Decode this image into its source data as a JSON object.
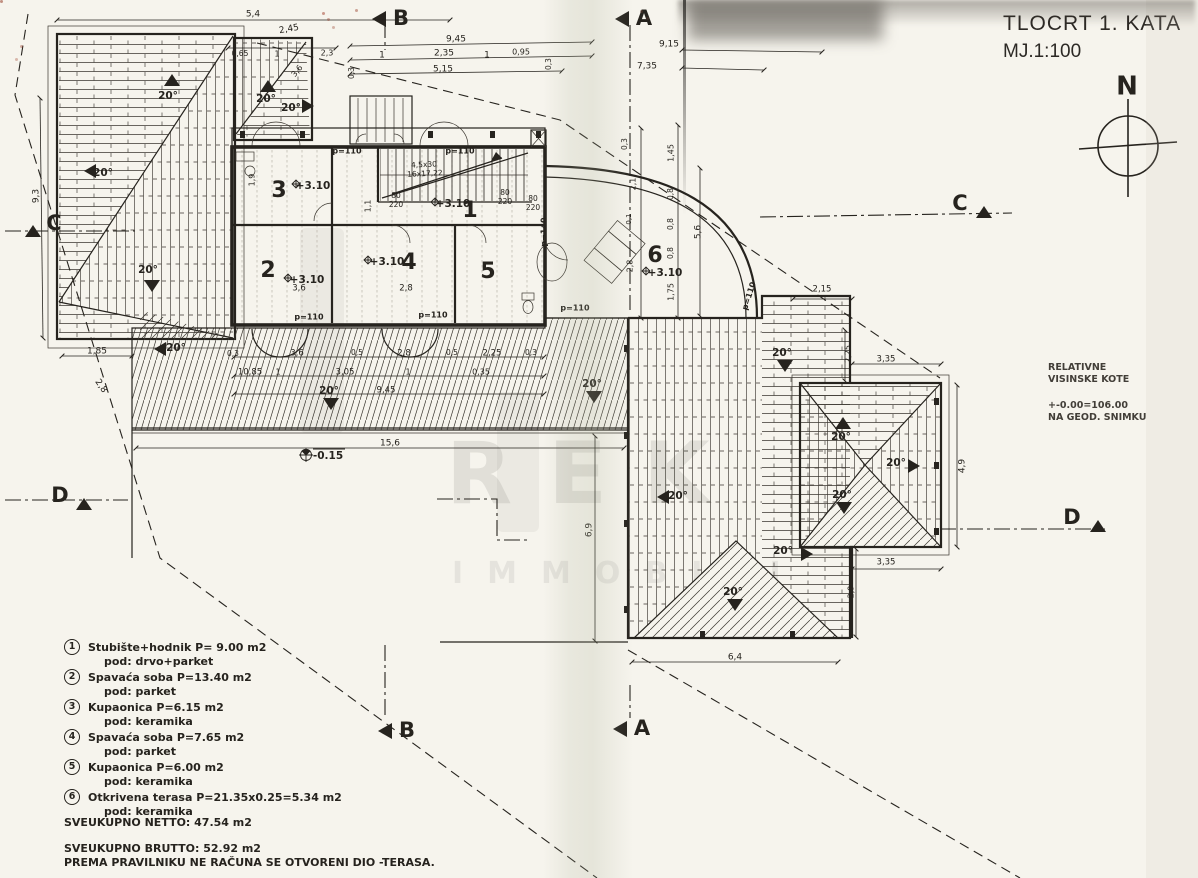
{
  "colors": {
    "ink": "#26231e",
    "paper": "#f6f4ed"
  },
  "title_block": {
    "title": "TLOCRT 1. KATA",
    "scale": "MJ.1:100"
  },
  "survey_note": {
    "line1": "RELATIVNE",
    "line2": "VISINSKE KOTE",
    "line3": "+-0.00=106.00",
    "line4": "NA GEOD. SNIMKU"
  },
  "watermark": {
    "big": "REK",
    "small": "IMMOBILI"
  },
  "legend": {
    "items": [
      {
        "num": "1",
        "desc": "Stubište+hodnik P= 9.00 m2",
        "floor": "pod: drvo+parket"
      },
      {
        "num": "2",
        "desc": "Spavaća soba P=13.40 m2",
        "floor": "pod: parket"
      },
      {
        "num": "3",
        "desc": "Kupaonica P=6.15 m2",
        "floor": "pod: keramika"
      },
      {
        "num": "4",
        "desc": "Spavaća soba P=7.65 m2",
        "floor": "pod: parket"
      },
      {
        "num": "5",
        "desc": "Kupaonica P=6.00 m2",
        "floor": "pod: keramika"
      },
      {
        "num": "6",
        "desc": "Otkrivena terasa P=21.35x0.25=5.34 m2",
        "floor": "pod: keramika"
      }
    ],
    "netto": "SVEUKUPNO NETTO: 47.54 m2",
    "brutto": "SVEUKUPNO BRUTTO: 52.92 m2",
    "note": "PREMA PRAVILNIKU NE RAČUNA SE OTVORENI DIO -TERASA."
  },
  "plan": {
    "annotations": [
      {
        "t": "B",
        "x": 401,
        "y": 19,
        "s": 21,
        "b": 1
      },
      {
        "t": "A",
        "x": 644,
        "y": 19,
        "s": 21,
        "b": 1
      },
      {
        "t": "C",
        "x": 54,
        "y": 224,
        "s": 21,
        "b": 1
      },
      {
        "t": "C",
        "x": 960,
        "y": 204,
        "s": 21,
        "b": 1
      },
      {
        "t": "D",
        "x": 60,
        "y": 496,
        "s": 21,
        "b": 1
      },
      {
        "t": "D",
        "x": 1072,
        "y": 518,
        "s": 21,
        "b": 1
      },
      {
        "t": "B",
        "x": 407,
        "y": 731,
        "s": 21,
        "b": 1
      },
      {
        "t": "A",
        "x": 642,
        "y": 729,
        "s": 21,
        "b": 1
      },
      {
        "t": "N",
        "x": 1127,
        "y": 87,
        "s": 26,
        "b": 1
      },
      {
        "t": "3",
        "x": 279,
        "y": 191,
        "s": 22,
        "b": 1
      },
      {
        "t": "2",
        "x": 268,
        "y": 271,
        "s": 22,
        "b": 1
      },
      {
        "t": "4",
        "x": 409,
        "y": 263,
        "s": 22,
        "b": 1
      },
      {
        "t": "1",
        "x": 470,
        "y": 211,
        "s": 22,
        "b": 1
      },
      {
        "t": "5",
        "x": 488,
        "y": 272,
        "s": 22,
        "b": 1
      },
      {
        "t": "6",
        "x": 655,
        "y": 256,
        "s": 22,
        "b": 1
      },
      {
        "t": "+3.10",
        "x": 313,
        "y": 186,
        "s": 10.5,
        "b": 1
      },
      {
        "t": "+3.10",
        "x": 307,
        "y": 280,
        "s": 10.5,
        "b": 1
      },
      {
        "t": "+3.10",
        "x": 387,
        "y": 262,
        "s": 10.5,
        "b": 1
      },
      {
        "t": "+3.10",
        "x": 453,
        "y": 204,
        "s": 10.5,
        "b": 1
      },
      {
        "t": "+3.10",
        "x": 665,
        "y": 273,
        "s": 10.5,
        "b": 1
      },
      {
        "t": "-0.15",
        "x": 328,
        "y": 456,
        "s": 10.5,
        "b": 1
      },
      {
        "t": "p=110",
        "x": 347,
        "y": 151,
        "s": 8,
        "b": 1
      },
      {
        "t": "p=110",
        "x": 460,
        "y": 151,
        "s": 8,
        "b": 1
      },
      {
        "t": "p=110",
        "x": 309,
        "y": 317,
        "s": 8,
        "b": 1
      },
      {
        "t": "p=110",
        "x": 433,
        "y": 315,
        "s": 8,
        "b": 1
      },
      {
        "t": "p=110",
        "x": 575,
        "y": 308,
        "s": 8,
        "b": 1
      },
      {
        "t": "p=110",
        "x": 749,
        "y": 296,
        "r": -72,
        "s": 8,
        "b": 1
      },
      {
        "t": "p=140",
        "x": 544,
        "y": 232,
        "r": -90,
        "s": 8,
        "b": 1
      },
      {
        "t": "80",
        "x": 396,
        "y": 196,
        "s": 7.5
      },
      {
        "t": "220",
        "x": 396,
        "y": 205,
        "s": 7.5
      },
      {
        "t": "80",
        "x": 505,
        "y": 193,
        "s": 7.5
      },
      {
        "t": "220",
        "x": 505,
        "y": 202,
        "s": 7.5
      },
      {
        "t": "80",
        "x": 533,
        "y": 199,
        "s": 7.5
      },
      {
        "t": "220",
        "x": 533,
        "y": 208,
        "s": 7.5
      },
      {
        "t": "4,5x30",
        "x": 424,
        "y": 165,
        "r": -3,
        "s": 7.5
      },
      {
        "t": "16x17,22",
        "x": 425,
        "y": 174,
        "r": -3,
        "s": 7.5
      },
      {
        "t": "20°",
        "x": 168,
        "y": 96,
        "s": 10.5,
        "b": 1
      },
      {
        "t": "20°",
        "x": 266,
        "y": 99,
        "s": 10.5,
        "b": 1
      },
      {
        "t": "20°",
        "x": 291,
        "y": 108,
        "s": 10.5,
        "b": 1
      },
      {
        "t": "20°",
        "x": 103,
        "y": 173,
        "s": 10.5,
        "b": 1
      },
      {
        "t": "20°",
        "x": 148,
        "y": 270,
        "s": 10.5,
        "b": 1
      },
      {
        "t": "20°",
        "x": 176,
        "y": 348,
        "s": 10.5,
        "b": 1
      },
      {
        "t": "20°",
        "x": 329,
        "y": 391,
        "s": 10.5,
        "b": 1
      },
      {
        "t": "20°",
        "x": 592,
        "y": 384,
        "s": 10.5,
        "b": 1
      },
      {
        "t": "20°",
        "x": 782,
        "y": 353,
        "s": 10.5,
        "b": 1
      },
      {
        "t": "20°",
        "x": 783,
        "y": 551,
        "s": 10.5,
        "b": 1
      },
      {
        "t": "20°",
        "x": 733,
        "y": 592,
        "s": 10.5,
        "b": 1
      },
      {
        "t": "20°",
        "x": 841,
        "y": 437,
        "s": 10.5,
        "b": 1
      },
      {
        "t": "20°",
        "x": 896,
        "y": 463,
        "s": 10.5,
        "b": 1
      },
      {
        "t": "20°",
        "x": 842,
        "y": 495,
        "s": 10.5,
        "b": 1
      },
      {
        "t": "20°",
        "x": 678,
        "y": 496,
        "s": 10.5,
        "b": 1
      },
      {
        "t": "5,4",
        "x": 253,
        "y": 14
      },
      {
        "t": "2,45",
        "x": 289,
        "y": 29,
        "r": -10
      },
      {
        "t": "9,45",
        "x": 456,
        "y": 39
      },
      {
        "t": "2,35",
        "x": 444,
        "y": 53
      },
      {
        "t": "1",
        "x": 382,
        "y": 55
      },
      {
        "t": "1",
        "x": 487,
        "y": 55
      },
      {
        "t": "0,95",
        "x": 521,
        "y": 52,
        "s": 8
      },
      {
        "t": "5,15",
        "x": 443,
        "y": 69
      },
      {
        "t": "0,3",
        "x": 549,
        "y": 64,
        "r": -90,
        "s": 7.5
      },
      {
        "t": "9,15",
        "x": 669,
        "y": 44
      },
      {
        "t": "7,35",
        "x": 647,
        "y": 66
      },
      {
        "t": "0,65",
        "x": 240,
        "y": 54,
        "s": 7.5
      },
      {
        "t": "1",
        "x": 277,
        "y": 54,
        "s": 8
      },
      {
        "t": "2,3",
        "x": 327,
        "y": 53,
        "s": 8
      },
      {
        "t": "3,6",
        "x": 297,
        "y": 71,
        "r": -50,
        "s": 8
      },
      {
        "t": "0,3",
        "x": 352,
        "y": 73,
        "r": -90,
        "s": 7.5
      },
      {
        "t": "9,3",
        "x": 36,
        "y": 196,
        "r": -90
      },
      {
        "t": "1,85",
        "x": 97,
        "y": 351
      },
      {
        "t": "2,8",
        "x": 101,
        "y": 386,
        "r": 55
      },
      {
        "t": "1,9",
        "x": 252,
        "y": 180,
        "r": -90,
        "s": 8
      },
      {
        "t": "1,1",
        "x": 368,
        "y": 206,
        "r": -90,
        "s": 8
      },
      {
        "t": "3,6",
        "x": 299,
        "y": 288,
        "s": 8.5
      },
      {
        "t": "2,8",
        "x": 406,
        "y": 288,
        "s": 8.5
      },
      {
        "t": "0,3",
        "x": 233,
        "y": 354,
        "s": 7.5
      },
      {
        "t": "3,6",
        "x": 297,
        "y": 353,
        "s": 8.5
      },
      {
        "t": "0,5",
        "x": 357,
        "y": 353,
        "s": 7.5
      },
      {
        "t": "2,8",
        "x": 404,
        "y": 353,
        "s": 8.5
      },
      {
        "t": "0,5",
        "x": 452,
        "y": 353,
        "s": 7.5
      },
      {
        "t": "2,25",
        "x": 492,
        "y": 353,
        "s": 8.5
      },
      {
        "t": "0,3",
        "x": 531,
        "y": 353,
        "s": 7.5
      },
      {
        "t": "10,85",
        "x": 250,
        "y": 372,
        "s": 8.5
      },
      {
        "t": "1",
        "x": 278,
        "y": 372,
        "s": 8
      },
      {
        "t": "3,05",
        "x": 345,
        "y": 372,
        "s": 8.5
      },
      {
        "t": "1",
        "x": 408,
        "y": 372,
        "s": 8
      },
      {
        "t": "0,35",
        "x": 481,
        "y": 372,
        "s": 8
      },
      {
        "t": "9,45",
        "x": 386,
        "y": 390,
        "s": 8.5
      },
      {
        "t": "15,6",
        "x": 390,
        "y": 443
      },
      {
        "t": "6,9",
        "x": 589,
        "y": 530,
        "r": -90
      },
      {
        "t": "0,3",
        "x": 625,
        "y": 144,
        "r": -90,
        "s": 7.5
      },
      {
        "t": "2,1",
        "x": 633,
        "y": 184,
        "r": -90,
        "s": 8
      },
      {
        "t": "0,1",
        "x": 629,
        "y": 219,
        "r": -90,
        "s": 7
      },
      {
        "t": "2,8",
        "x": 630,
        "y": 266,
        "r": -90,
        "s": 8
      },
      {
        "t": "1,45",
        "x": 671,
        "y": 153,
        "r": -90,
        "s": 8
      },
      {
        "t": "0,8",
        "x": 671,
        "y": 194,
        "r": -90,
        "s": 7.5
      },
      {
        "t": "0,8",
        "x": 671,
        "y": 224,
        "r": -90,
        "s": 7.5
      },
      {
        "t": "0,8",
        "x": 671,
        "y": 253,
        "r": -90,
        "s": 7.5
      },
      {
        "t": "1,75",
        "x": 671,
        "y": 292,
        "r": -90,
        "s": 8
      },
      {
        "t": "5,6",
        "x": 698,
        "y": 232,
        "r": -90
      },
      {
        "t": "2,15",
        "x": 822,
        "y": 289,
        "s": 8.5
      },
      {
        "t": "2,25",
        "x": 848,
        "y": 354,
        "r": -90,
        "s": 8
      },
      {
        "t": "3,35",
        "x": 886,
        "y": 359,
        "s": 8.5
      },
      {
        "t": "4,9",
        "x": 962,
        "y": 466,
        "r": -90
      },
      {
        "t": "3,35",
        "x": 886,
        "y": 562,
        "s": 8.5
      },
      {
        "t": "2,9",
        "x": 851,
        "y": 592,
        "r": -90,
        "s": 8
      },
      {
        "t": "6,4",
        "x": 735,
        "y": 657
      }
    ]
  }
}
